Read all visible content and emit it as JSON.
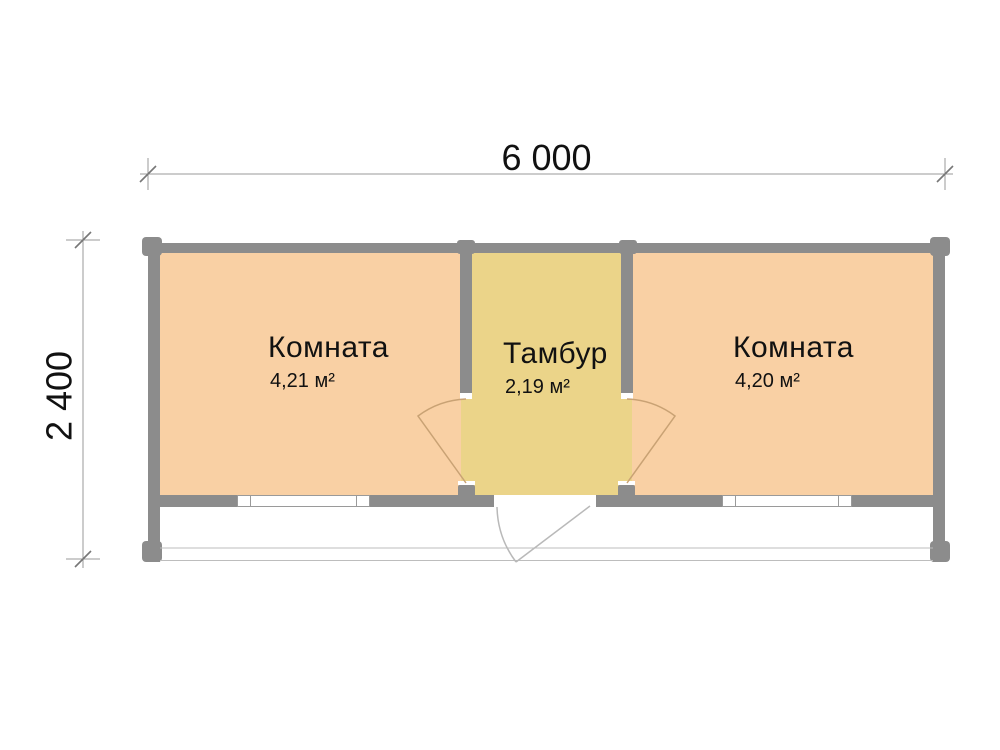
{
  "dimensions": {
    "width": "6 000",
    "height": "2 400"
  },
  "rooms": [
    {
      "name": "Комната",
      "area": "4,21 м²"
    },
    {
      "name": "Тамбур",
      "area": "2,19 м²"
    },
    {
      "name": "Комната",
      "area": "4,20 м²"
    }
  ],
  "colors": {
    "wall": "#8c8c8c",
    "room": "#f9d0a4",
    "tambour": "#ebd489",
    "door": "#c9a274",
    "exterior_door": "#b9b9b9",
    "dimension": "#9a9a9a",
    "porch": "#bdbdbd",
    "text": "#111111"
  }
}
